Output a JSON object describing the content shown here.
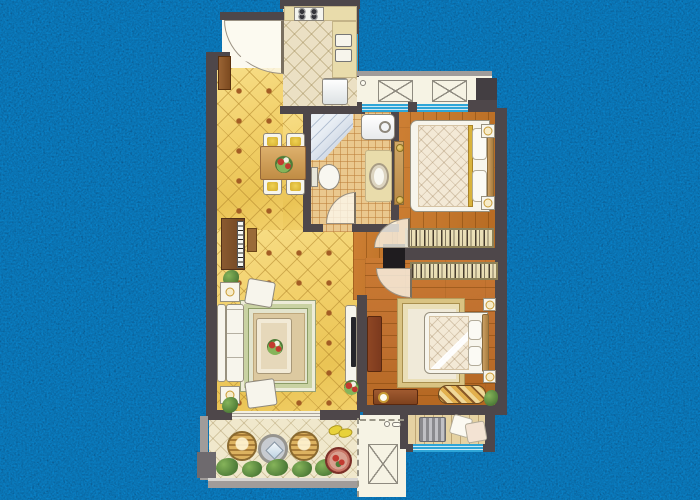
{
  "scene": {
    "type": "architectural-floor-plan",
    "description": "Hand-rendered two-bedroom apartment floor plan centered on a dark mottled navy background",
    "visible_text": "none"
  },
  "colors": {
    "bg": "#0a141f",
    "speckle": "#2b5078",
    "wall": "#4e474a",
    "wallLight": "#a09c9a",
    "pillar": "#1f1c1f",
    "window": "#2ea6d8",
    "windowPale": "#cdeaf5",
    "tileYellow": "#f2d06a",
    "tileAccent": "#a35c24",
    "tileCream": "#ebe0c4",
    "tileBath": "#eac88e",
    "wood1": "#c4772c",
    "wood2": "#bf7030",
    "woodPale": "#e5d2a2",
    "platform": "#f6f3e4",
    "balconyTile": "#f0e8cc",
    "counter": "#e9dcab",
    "furnWhite": "#f7f5ec",
    "furnLine": "#98917f",
    "desk": "#7c3a1e",
    "duvet": "#f3e9d6",
    "wardrobe": "#e7dcb2",
    "gold": "#c89a34",
    "green": "#4e7c38",
    "greenLight": "#86b45a",
    "red": "#c23a30",
    "tv": "#26262a",
    "rugBorder": "#c9d2a2",
    "rugInner": "#dcc9a0",
    "rugCenter": "#f0ead9",
    "shower": "#d6dee9"
  },
  "rooms": [
    {
      "id": "entry",
      "furniture": [
        "entry-door-swing",
        "shoe-cabinet"
      ]
    },
    {
      "id": "kitchen",
      "furniture": [
        "gas-stove",
        "counter",
        "double-sink",
        "refrigerator",
        "side-window"
      ]
    },
    {
      "id": "dining-area",
      "furniture": [
        "dining-table",
        "dining-chairs-x4",
        "flower-centerpiece",
        "piano",
        "piano-bench",
        "plant"
      ]
    },
    {
      "id": "living-room",
      "furniture": [
        "l-shaped-sofa",
        "armchair-x2",
        "side-table-with-lamp-x2",
        "coffee-table",
        "layered-area-rug",
        "tv-cabinet",
        "tv",
        "flower-pot",
        "corner-plants"
      ]
    },
    {
      "id": "bathroom",
      "furniture": [
        "corner-shower",
        "washing-machine",
        "toilet",
        "washstand-with-basin",
        "door-swing"
      ]
    },
    {
      "id": "bedroom-1",
      "furniture": [
        "double-bed",
        "pillows-x2",
        "nightstand-with-lamp-x2",
        "tall-dresser",
        "wardrobe-with-hanging-clothes",
        "window",
        "door-swing"
      ]
    },
    {
      "id": "bedroom-2",
      "furniture": [
        "double-bed",
        "pillows-x2",
        "nightstand-with-lamp-x2",
        "wardrobe-with-hanging-clothes",
        "gold-border-rug",
        "desk",
        "dresser-with-clock",
        "striped-bench",
        "plant",
        "door-swing"
      ]
    },
    {
      "id": "front-balcony",
      "furniture": [
        "rattan-chair-x2",
        "round-glass-table",
        "planter-greenery",
        "slippers",
        "snack-table"
      ]
    },
    {
      "id": "ac-platform-top",
      "furniture": [
        "ac-unit-crossed-box-x2",
        "drain-symbol"
      ]
    },
    {
      "id": "equipment-platform",
      "furniture": [
        "ac-unit-crossed-box",
        "faucet-symbol",
        "dashed-boundary"
      ]
    },
    {
      "id": "rear-balcony",
      "furniture": [
        "slat-rack",
        "cushion-x2",
        "window"
      ]
    }
  ]
}
